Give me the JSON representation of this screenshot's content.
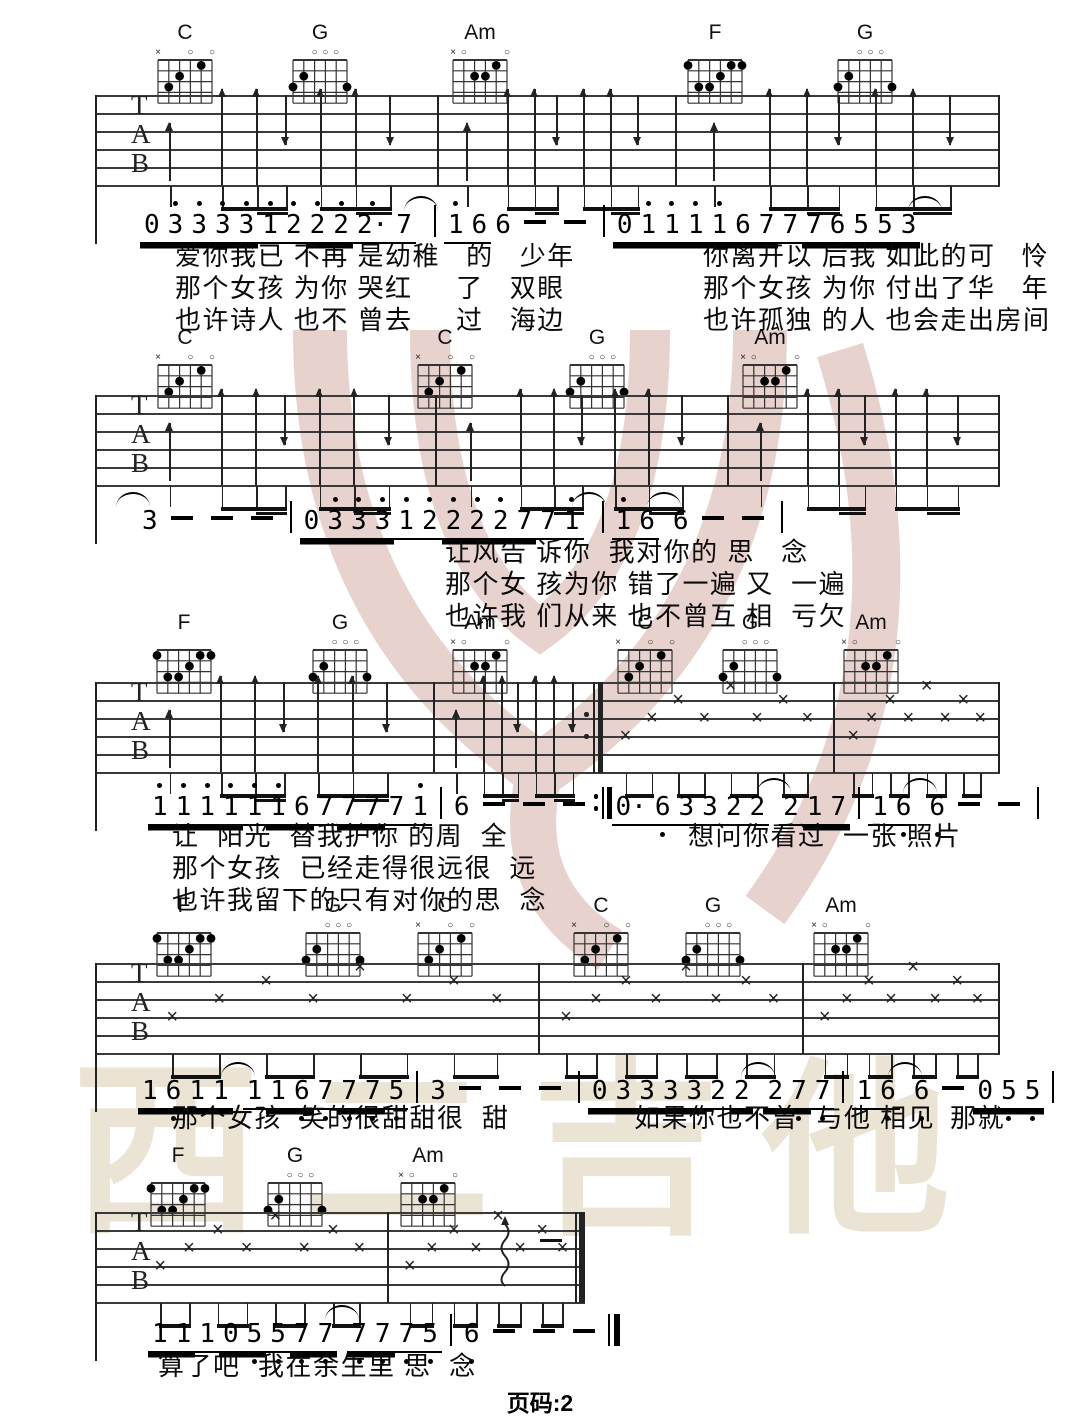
{
  "page": {
    "footer_label": "页码:2",
    "watermark_text": "西二吉他",
    "watermark_text_color": "#ebe3d4",
    "logo_color": "#c9958a"
  },
  "chord_shapes": {
    "C": {
      "markers": [
        [
          "x",
          1
        ],
        [
          "o",
          4
        ],
        [
          "o",
          6
        ]
      ],
      "dots": [
        [
          2,
          3
        ],
        [
          3,
          2
        ],
        [
          5,
          1
        ]
      ]
    },
    "G": {
      "markers": [
        [
          "o",
          3
        ],
        [
          "o",
          4
        ],
        [
          "o",
          5
        ]
      ],
      "dots": [
        [
          1,
          3
        ],
        [
          2,
          2
        ],
        [
          6,
          3
        ]
      ]
    },
    "Am": {
      "markers": [
        [
          "x",
          1
        ],
        [
          "o",
          2
        ],
        [
          "o",
          6
        ]
      ],
      "dots": [
        [
          3,
          2
        ],
        [
          4,
          2
        ],
        [
          5,
          1
        ]
      ]
    },
    "F": {
      "markers": [],
      "dots": [
        [
          1,
          1
        ],
        [
          5,
          1
        ],
        [
          6,
          1
        ],
        [
          4,
          2
        ],
        [
          2,
          3
        ],
        [
          3,
          3
        ]
      ]
    }
  },
  "systems": [
    {
      "chord_y": 22,
      "chords": [
        [
          "C",
          185
        ],
        [
          "G",
          320
        ],
        [
          "Am",
          480
        ],
        [
          "F",
          715
        ],
        [
          "G",
          865
        ]
      ],
      "staff": {
        "x1": 95,
        "x2": 1000,
        "y": 95,
        "bars": [
          437,
          675
        ],
        "types": [
          "arrows",
          "arrows",
          "arrows"
        ],
        "end": "bar"
      },
      "melody": {
        "x": 140,
        "y": 196,
        "tokens": "0= 3'= 3'= 3'= 3'= 1'_ 2'_ 2'= 2'= 2'._ 7_ ( | 1'_ 6_ 6 - - | 0= 1'= 1'= 1'= 1'= 6= 7= 7_ 7= 6= 5= 5= 3= ("
      },
      "lyrics": [
        [
          175,
          236,
          "爱你我已 不再 是幼稚   的   少年"
        ],
        [
          703,
          236,
          "你离开以 后我 如此的可   怜"
        ],
        [
          175,
          268,
          "那个女孩 为你 哭红     了   双眼"
        ],
        [
          703,
          268,
          "那个女孩 为你 付出了华   年"
        ],
        [
          175,
          300,
          "也许诗人 也不 曾去     过   海边"
        ],
        [
          703,
          300,
          "也许孤独 的人 也会走出房间"
        ]
      ]
    },
    {
      "chord_y": 327,
      "chords": [
        [
          "C",
          185
        ],
        [
          "C",
          445
        ],
        [
          "G",
          597
        ],
        [
          "Am",
          770
        ]
      ],
      "staff": {
        "x1": 95,
        "x2": 1000,
        "y": 395,
        "bars": [
          435,
          727
        ],
        "types": [
          "arrows",
          "arrows",
          "arrows"
        ],
        "end": "bar"
      },
      "melody": {
        "x": 128,
        "y": 492,
        "tokens": "( 3 - - - | 0= 3'= 3'= 3'= 1'_ 2'_ 2'= 2'= 2'= 7= 7_ 1'_ ( | 1'_ 6_ ( 6 - - |"
      },
      "lyrics": [
        [
          445,
          532,
          "让风告 诉你  我对你的 思   念"
        ],
        [
          445,
          564,
          "那个女 孩为你 错了一遍 又  一遍"
        ],
        [
          445,
          596,
          "也许我 们从来 也不曾互 相  亏欠"
        ]
      ]
    },
    {
      "chord_y": 612,
      "chords": [
        [
          "F",
          184
        ],
        [
          "G",
          340
        ],
        [
          "Am",
          480
        ],
        [
          "C",
          645
        ],
        [
          "G",
          750
        ],
        [
          "Am",
          871
        ]
      ],
      "staff": {
        "x1": 95,
        "x2": 1000,
        "y": 682,
        "bars": [
          433,
          "600r",
          833
        ],
        "types": [
          "arrows",
          "arrows",
          "crosses",
          "crosses"
        ],
        "end": "bar"
      },
      "melody": {
        "x": 148,
        "y": 778,
        "tokens": "1'= 1'= 1'= 1'= 1'_ 1'= 6= 7_ 7= 7= 7_ 1'_ | 6 - - - :|| 0._ 6,_ 3_ 3_ 2_ 2_ ( 2_ 1= 7= | 1_ 6,_ ( 6, - - |"
      },
      "lyrics": [
        [
          172,
          816,
          "让  阳光  替我护你 的周  全"
        ],
        [
          688,
          816,
          "想问你看过  一张 照片"
        ],
        [
          172,
          848,
          "那个女孩  已经走得很远很  远"
        ],
        [
          172,
          880,
          "也许我留下的只有对你的思  念"
        ]
      ]
    },
    {
      "chord_y": 895,
      "chords": [
        [
          "F",
          184
        ],
        [
          "G",
          333
        ],
        [
          "C",
          445
        ],
        [
          "C",
          601
        ],
        [
          "G",
          713
        ],
        [
          "Am",
          841
        ]
      ],
      "staff": {
        "x1": 95,
        "x2": 1000,
        "y": 963,
        "bars": [
          538,
          802
        ],
        "types": [
          "crosses",
          "crosses",
          "crosses"
        ],
        "end": "bar"
      },
      "melody": {
        "x": 138,
        "y": 1062,
        "tokens": "1= 6,= 1= 1= ( 1_ 1= 6,= 7,_ 7,= 7,= 5,_ | 3 - - - | 0= 3= 3= 3= 3= 2_ 2= ( 2= 7,= 7,_ | 1_ 6,_ ( 6, - 0= 5,= 5,= |"
      },
      "lyrics": [
        [
          172,
          1098,
          "那个女孩  笑的很甜甜很  甜"
        ],
        [
          634,
          1098,
          "如果你也不曾  与他 相见"
        ],
        [
          950,
          1098,
          "那就"
        ]
      ]
    },
    {
      "chord_y": 1145,
      "chords": [
        [
          "F",
          178
        ],
        [
          "G",
          295
        ],
        [
          "Am",
          428
        ]
      ],
      "staff": {
        "x1": 95,
        "x2": 585,
        "y": 1212,
        "bars": [
          387
        ],
        "types": [
          "crosses",
          "crosses"
        ],
        "end": "final",
        "wavy": 505,
        "enddash": 540
      },
      "melody": {
        "x": 148,
        "y": 1305,
        "tokens": "1= 1= 1_ 0= 5,= 5,_ 7,= 7,= ( 7,= 7,= 7,_ 5,_ | 6, - - - ||"
      },
      "lyrics": [
        [
          158,
          1346,
          "算了吧  我在余生里 思  念"
        ]
      ]
    }
  ]
}
